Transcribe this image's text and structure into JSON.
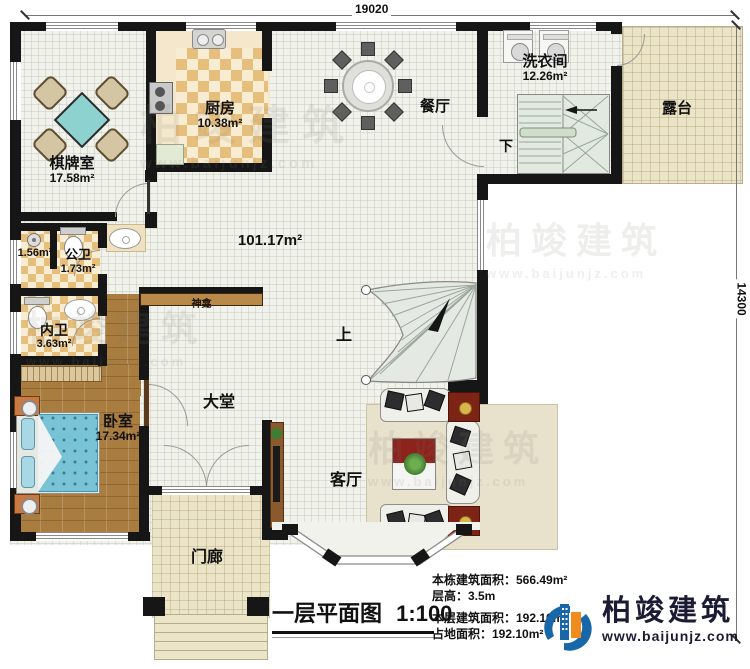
{
  "dimensions": {
    "width_label": "19020",
    "height_label": "14300"
  },
  "title": {
    "text": "一层平面图",
    "scale": "1:100"
  },
  "stats": {
    "building_total": "本栋建筑面积：566.49m²",
    "floor_height": "层高：3.5m",
    "floor_area": "本层建筑面积：192.10m²",
    "footprint": "占地面积：192.10m²"
  },
  "logo": {
    "name": "柏竣建筑",
    "url": "www.baijunjz.com"
  },
  "watermark": {
    "text": "柏竣建筑",
    "url": "www.baijunjz.com"
  },
  "rooms": {
    "chess": {
      "name": "棋牌室",
      "area": "17.58m²"
    },
    "kitchen": {
      "name": "厨房",
      "area": "10.38m²"
    },
    "dining": {
      "name": "餐厅"
    },
    "laundry": {
      "name": "洗衣间",
      "area": "12.26m²"
    },
    "terrace": {
      "name": "露台"
    },
    "great_room": {
      "area": "101.17m²"
    },
    "shower_room": {
      "area": "1.56m²"
    },
    "public_bath": {
      "name": "公卫",
      "area": "1.73m²"
    },
    "inner_bath": {
      "name": "内卫",
      "area": "3.63m²"
    },
    "bedroom": {
      "name": "卧室",
      "area": "17.34m²"
    },
    "lobby": {
      "name": "大堂"
    },
    "living": {
      "name": "客厅"
    },
    "porch": {
      "name": "门廊"
    },
    "shrine": {
      "name": "神龛"
    }
  },
  "stairs": {
    "up": "上",
    "down": "下"
  }
}
